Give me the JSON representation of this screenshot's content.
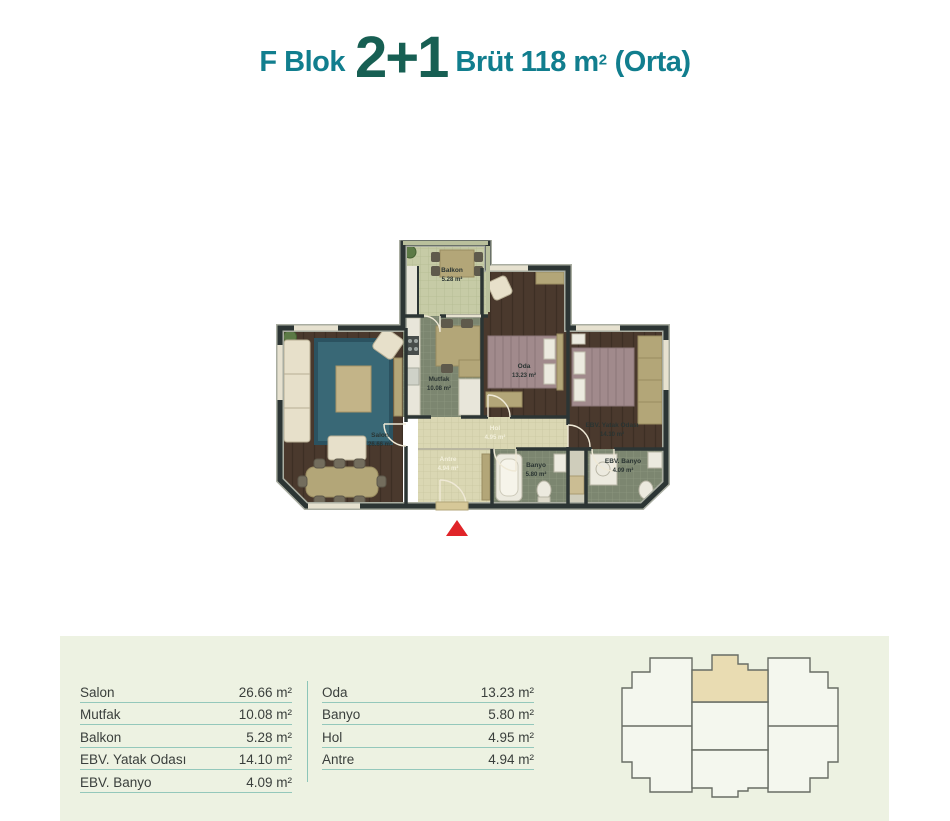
{
  "title": {
    "block": "F Blok",
    "unit_type": "2+1",
    "area_prefix": "Brüt 118 m",
    "area_exponent": "2",
    "variant": "(Orta)"
  },
  "colors": {
    "accent_teal": "#117e8e",
    "accent_dark_teal": "#175f53",
    "panel_background": "#edf2e2",
    "table_line": "#94c8bb",
    "highlighted_unit": "#e9dcb2",
    "wall": "#2c3534",
    "entrance_marker": "#e02428"
  },
  "plan": {
    "rooms": [
      {
        "name": "Balkon",
        "area": "5.28 m²"
      },
      {
        "name": "Mutfak",
        "area": "10.08 m²"
      },
      {
        "name": "Oda",
        "area": "13.23 m²"
      },
      {
        "name": "Salon",
        "area": "26.66 m²"
      },
      {
        "name": "EBV. Yatak Odası",
        "area": "14.10 m²"
      },
      {
        "name": "Hol",
        "area": "4.95 m²"
      },
      {
        "name": "Antre",
        "area": "4.94 m²"
      },
      {
        "name": "Banyo",
        "area": "5.80 m²"
      },
      {
        "name": "EBV. Banyo",
        "area": "4.09 m²"
      }
    ]
  },
  "table": {
    "left": [
      {
        "label": "Salon",
        "value": "26.66 m²"
      },
      {
        "label": "Mutfak",
        "value": "10.08 m²"
      },
      {
        "label": "Balkon",
        "value": "5.28 m²"
      },
      {
        "label": "EBV. Yatak Odası",
        "value": "14.10 m²"
      },
      {
        "label": "EBV. Banyo",
        "value": "4.09 m²"
      }
    ],
    "right": [
      {
        "label": "Oda",
        "value": "13.23 m²"
      },
      {
        "label": "Banyo",
        "value": "5.80 m²"
      },
      {
        "label": "Hol",
        "value": "4.95 m²"
      },
      {
        "label": "Antre",
        "value": "4.94 m²"
      }
    ]
  },
  "keyplan": {
    "highlighted_unit": "top-middle"
  }
}
